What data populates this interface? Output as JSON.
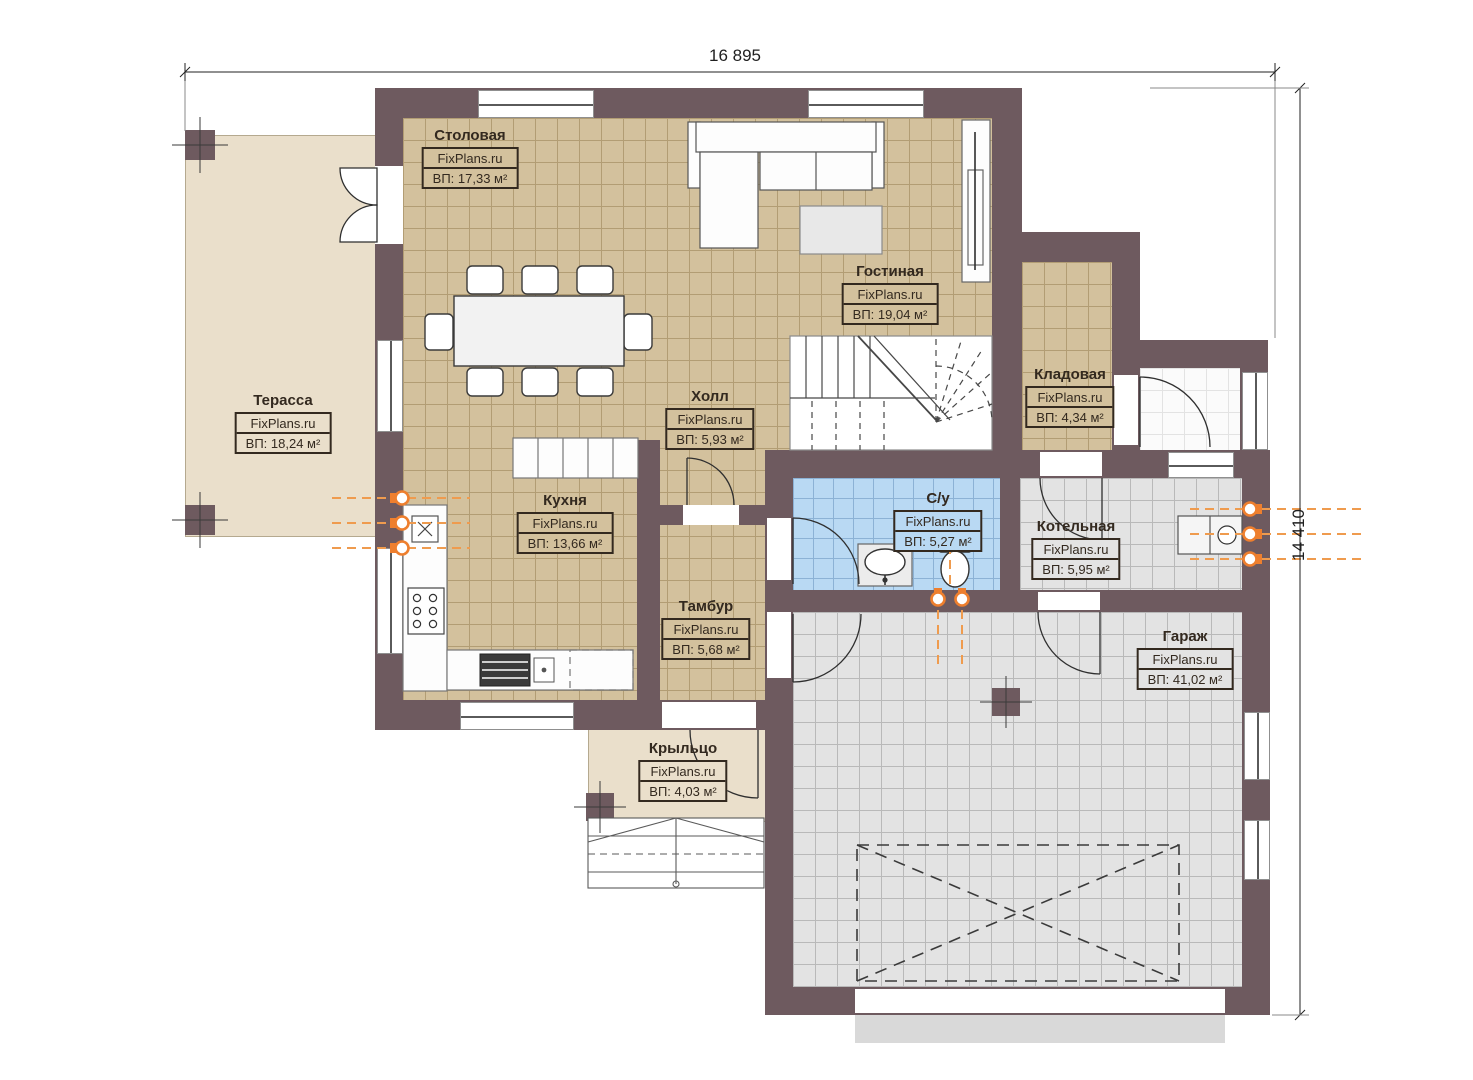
{
  "watermark": "FixPlans.ru",
  "dimensions": {
    "top": "16 895",
    "right": "14 410"
  },
  "rooms": {
    "terrace": {
      "name": "Терасса",
      "watermark": "FixPlans.ru",
      "area": "ВП: 18,24 м²"
    },
    "dining": {
      "name": "Столовая",
      "watermark": "FixPlans.ru",
      "area": "ВП: 17,33 м²"
    },
    "living": {
      "name": "Гостиная",
      "watermark": "FixPlans.ru",
      "area": "ВП: 19,04 м²"
    },
    "hall": {
      "name": "Холл",
      "watermark": "FixPlans.ru",
      "area": "ВП: 5,93 м²"
    },
    "kitchen": {
      "name": "Кухня",
      "watermark": "FixPlans.ru",
      "area": "ВП: 13,66 м²"
    },
    "storage": {
      "name": "Кладовая",
      "watermark": "FixPlans.ru",
      "area": "ВП: 4,34 м²"
    },
    "bathroom": {
      "name": "С/у",
      "watermark": "FixPlans.ru",
      "area": "ВП: 5,27 м²"
    },
    "boiler": {
      "name": "Котельная",
      "watermark": "FixPlans.ru",
      "area": "ВП: 5,95 м²"
    },
    "vestibule": {
      "name": "Тамбур",
      "watermark": "FixPlans.ru",
      "area": "ВП: 5,68 м²"
    },
    "garage": {
      "name": "Гараж",
      "watermark": "FixPlans.ru",
      "area": "ВП: 41,02 м²"
    },
    "porch": {
      "name": "Крыльцо",
      "watermark": "FixPlans.ru",
      "area": "ВП: 4,03 м²"
    }
  },
  "colors": {
    "wall": "#6e5a5f",
    "floor_wood": "#d3c19d",
    "floor_tile_gray": "#e3e3e3",
    "floor_tile_blue": "#b9d9f3",
    "terrace_floor": "#eadfcb",
    "heating_accent": "#ee7f2e"
  }
}
